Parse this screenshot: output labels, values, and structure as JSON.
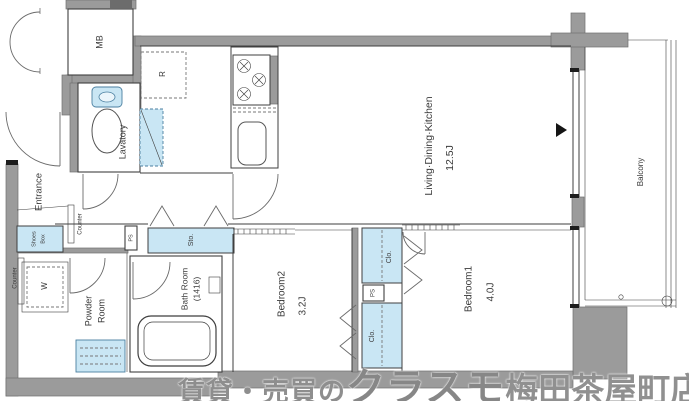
{
  "plan": {
    "rooms": {
      "ldk_name": "Living·Dining·Kitchen",
      "ldk_size": "12.5J",
      "bedroom1_name": "Bedroom1",
      "bedroom1_size": "4.0J",
      "bedroom2_name": "Bedroom2",
      "bedroom2_size": "3.2J",
      "bath_name": "Bath Room",
      "bath_size": "(1416)",
      "powder_line1": "Powder",
      "powder_line2": "Room",
      "lavatory": "Lavatory",
      "entrance": "Entrance",
      "balcony": "Balcony"
    },
    "fixtures": {
      "mb": "MB",
      "fridge": "R",
      "washer": "W",
      "shoes_line1": "Shoes",
      "shoes_line2": "Box",
      "counter": "Counter",
      "storage": "Sto.",
      "closet": "Clo.",
      "pipe_space": "PS"
    }
  },
  "watermark": {
    "prefix": "賃貸・売買の",
    "brand": "クラスモ",
    "store": "梅田茶屋町店"
  },
  "colors": {
    "fixture_blue": "#c9e6f4",
    "wall_gray": "#9b9b9b",
    "watermark_gray": "#8e8e8e"
  }
}
